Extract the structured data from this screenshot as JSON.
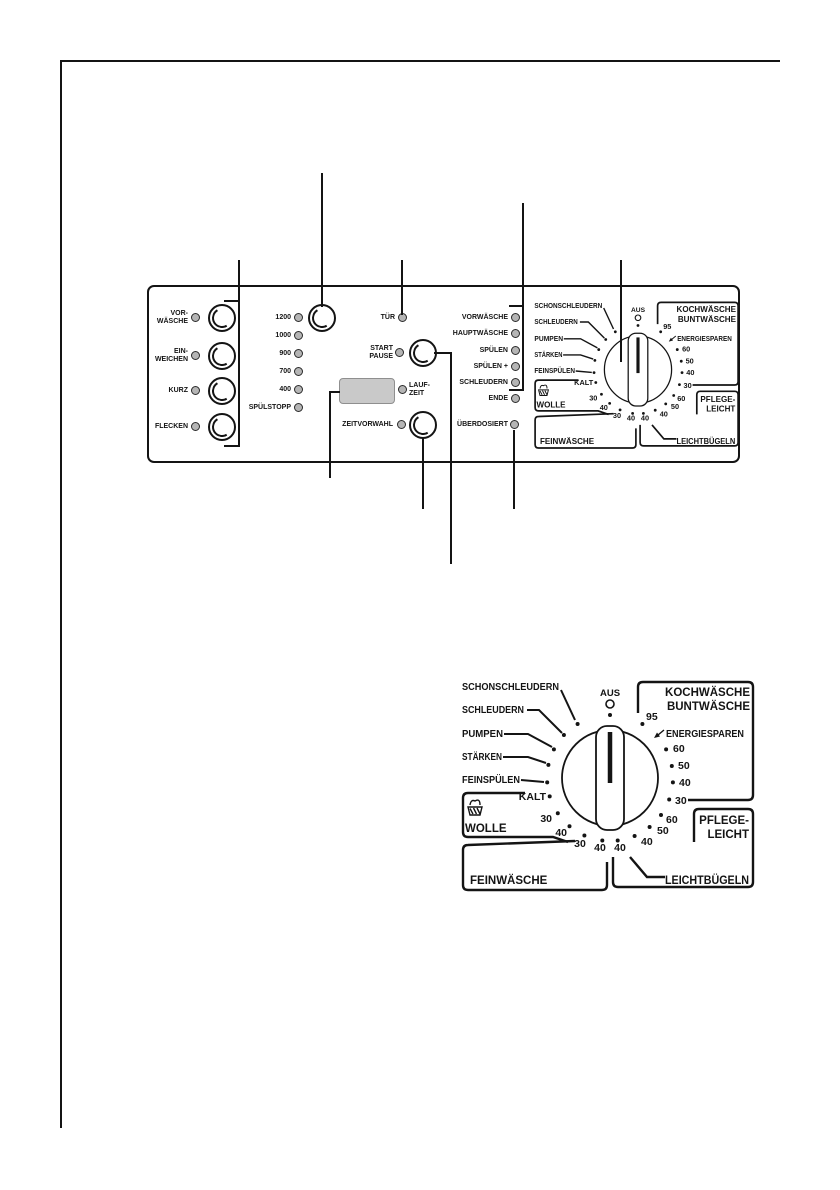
{
  "colors": {
    "ink": "#141414",
    "led_fill": "#b5b5b5",
    "display_fill": "#c9c9c9",
    "paper": "#ffffff"
  },
  "panel": {
    "option_buttons": [
      {
        "label": "VOR-\nWÄSCHE"
      },
      {
        "label": "EIN-\nWEICHEN"
      },
      {
        "label": "KURZ"
      },
      {
        "label": "FLECKEN"
      }
    ],
    "spin_rows": [
      "1200",
      "1000",
      "900",
      "700",
      "400",
      "SPÜLSTOPP"
    ],
    "tuer_label": "TÜR",
    "start_pause_label": "START\nPAUSE",
    "laufzeit_label": "LAUF-\nZEIT",
    "zeitvorwahl_label": "ZEITVORWAHL",
    "phase_rows": [
      "VORWÄSCHE",
      "HAUPTWÄSCHE",
      "SPÜLEN",
      "SPÜLEN +",
      "SCHLEUDERN",
      "ENDE"
    ],
    "ueberdosiert_label": "ÜBERDOSIERT"
  },
  "dial": {
    "aus": "AUS",
    "programs_left": [
      "SCHONSCHLEUDERN",
      "SCHLEUDERN",
      "PUMPEN",
      "STÄRKEN",
      "FEINSPÜLEN"
    ],
    "kalt": "KALT",
    "temps_right": [
      "95",
      "60",
      "50",
      "40",
      "30"
    ],
    "energiesparen": "ENERGIESPAREN",
    "bottom_marks": [
      "60",
      "50",
      "40",
      "40",
      "40",
      "30",
      "40",
      "30"
    ],
    "regions": {
      "kochwaesche_line1": "KOCHWÄSCHE",
      "kochwaesche_line2": "BUNTWÄSCHE",
      "pflegeleicht_line1": "PFLEGE-",
      "pflegeleicht_line2": "LEICHT",
      "leichtbuegeln": "LEICHTBÜGELN",
      "feinwaesche": "FEINWÄSCHE",
      "wolle": "WOLLE"
    }
  }
}
